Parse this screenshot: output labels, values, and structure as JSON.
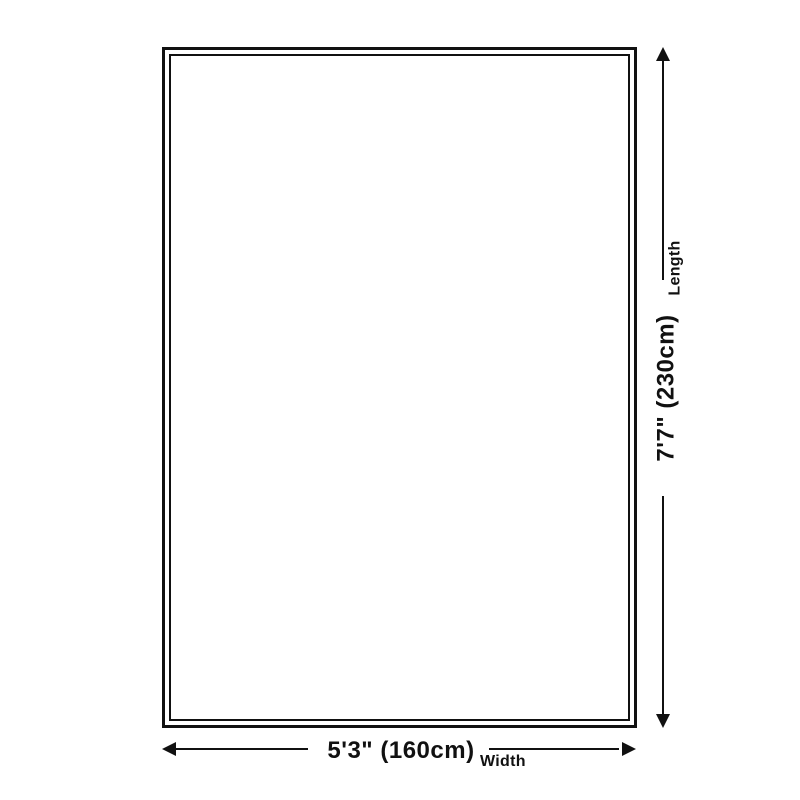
{
  "diagram": {
    "title": "rug-size-dimension-diagram",
    "length": {
      "label": "Length",
      "value": "7'7\" (230cm)"
    },
    "width": {
      "label": "Width",
      "value": "5'3\" (160cm)"
    },
    "colors": {
      "line": "#111111",
      "background": "#ffffff"
    }
  }
}
